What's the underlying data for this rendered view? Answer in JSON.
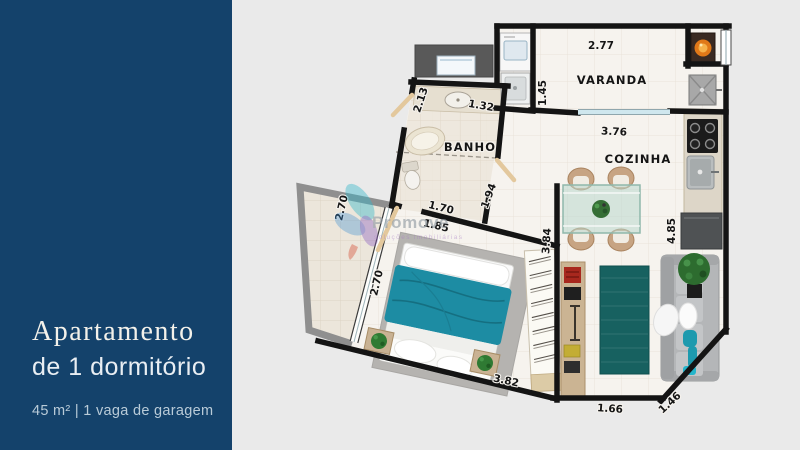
{
  "sidebar": {
    "title_line1": "Apartamento",
    "title_line2": "de 1 dormitório",
    "subtitle": "45 m² | 1 vaga de garagem"
  },
  "watermark": {
    "brand": "Promove",
    "tagline": "soluções imobiliárias"
  },
  "floorplan": {
    "room_labels": {
      "varanda": "VARANDA",
      "banho": "BANHO",
      "cozinha": "COZINHA"
    },
    "dims": {
      "varanda_width": "2.77",
      "varanda_depth": "1.45",
      "banho_side": "2.13",
      "banho_counter": "1.32",
      "cozinha_width": "3.76",
      "banho_width_inner": "1.70",
      "corridor_outer": "1.85",
      "banho_right": "1.94",
      "terrace_width": "2.70",
      "bedroom_window": "2.70",
      "closet_wall": "3.84",
      "kitchen_wall": "4.85",
      "bedroom_bottom": "3.82",
      "living_bottom": "1.66",
      "corner_diagonal": "1.46"
    },
    "colors": {
      "sidebar_bg": "#14426b",
      "background": "#eaeaea",
      "wall": "#141414",
      "bed_teal": "#1d8ca3",
      "rug_teal": "#176160",
      "door_wood": "#e3c89d"
    }
  }
}
